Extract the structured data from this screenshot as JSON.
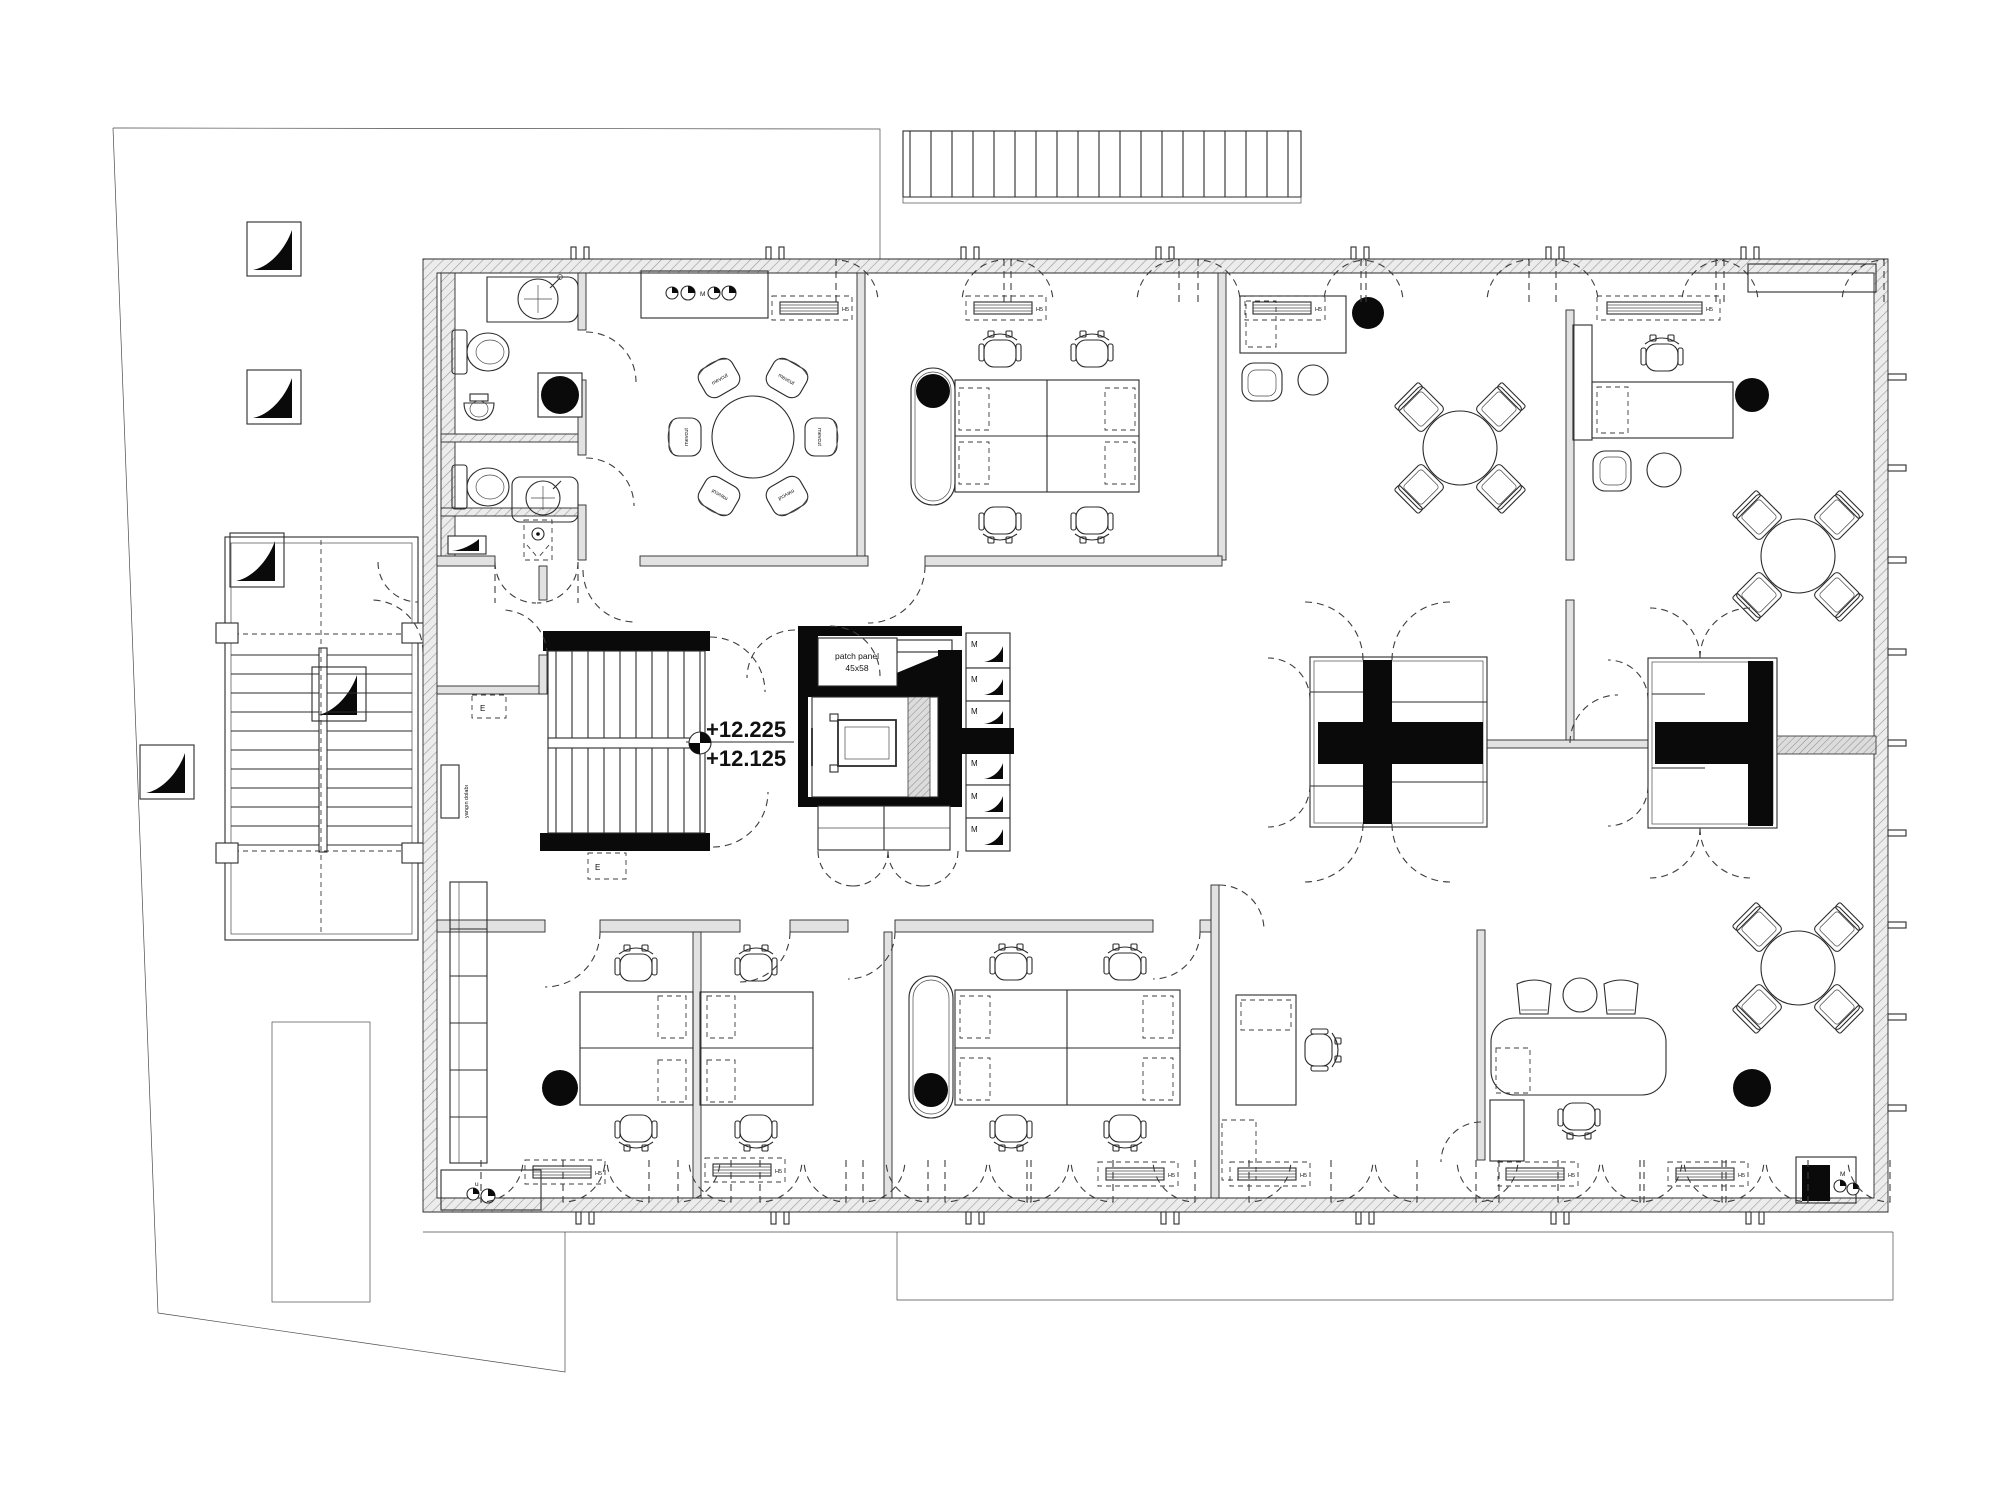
{
  "drawing": {
    "type": "architectural floor plan - office upper storey",
    "levels": {
      "upper": "+12.225",
      "lower": "+12.125"
    },
    "patch_panel": {
      "line1": "patch panel",
      "line2": "45x58"
    },
    "labels": {
      "locker": "M",
      "radiator": "H5",
      "chair_existing": "mevcut",
      "electrical": "E",
      "sink_small": "u",
      "corner_point": "M",
      "counter_point": "M",
      "fire_cabinet": "yangın dolabı"
    },
    "colors": {
      "line": "#2b2b2b",
      "wall_fill": "#e2e2e2",
      "hatch": "#9a9a9a",
      "solid_black": "#0a0a0a",
      "dashed": "#3c3c3c",
      "background": "#ffffff"
    }
  }
}
